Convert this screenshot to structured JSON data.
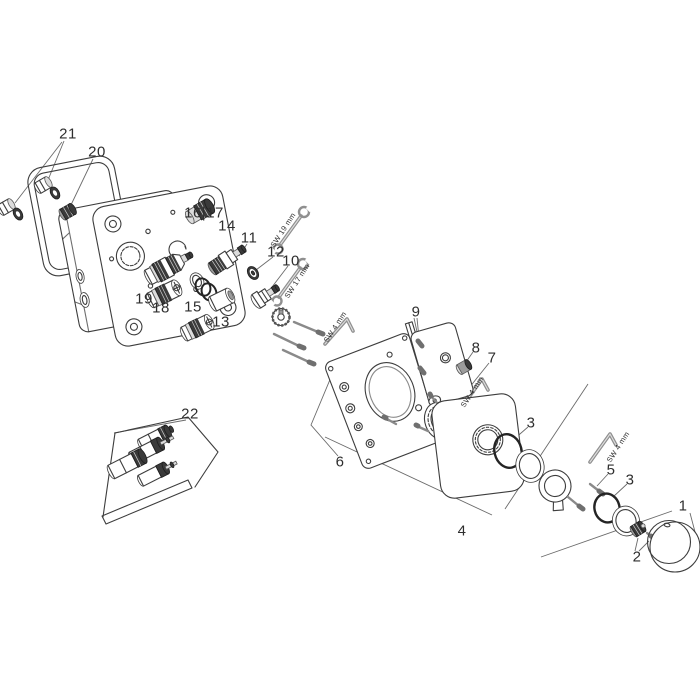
{
  "canvas": {
    "width": 700,
    "height": 700,
    "background": "#ffffff"
  },
  "style": {
    "line_color": "#3d3d3d",
    "dark_fill": "#3a3a3a",
    "leader_color": "#6b6b6b",
    "tool_color": "#8f8f8f",
    "label_color": "#2e2e2e"
  },
  "labels": {
    "parts": [
      {
        "text": "21",
        "x": 68,
        "y": 134
      },
      {
        "text": "20",
        "x": 97,
        "y": 152
      },
      {
        "text": "16|17",
        "x": 204,
        "y": 213
      },
      {
        "text": "14",
        "x": 227,
        "y": 226
      },
      {
        "text": "11",
        "x": 249,
        "y": 238
      },
      {
        "text": "12",
        "x": 276,
        "y": 252
      },
      {
        "text": "10",
        "x": 291,
        "y": 261
      },
      {
        "text": "19",
        "x": 144,
        "y": 299
      },
      {
        "text": "18",
        "x": 161,
        "y": 308
      },
      {
        "text": "15",
        "x": 193,
        "y": 307
      },
      {
        "text": "13",
        "x": 221,
        "y": 322
      },
      {
        "text": "9",
        "x": 416,
        "y": 312
      },
      {
        "text": "8",
        "x": 476,
        "y": 348
      },
      {
        "text": "7",
        "x": 492,
        "y": 358
      },
      {
        "text": "6",
        "x": 340,
        "y": 462
      },
      {
        "text": "22",
        "x": 190,
        "y": 414
      },
      {
        "text": "4",
        "x": 462,
        "y": 531
      },
      {
        "text": "3",
        "x": 531,
        "y": 423
      },
      {
        "text": "5",
        "x": 611,
        "y": 470
      },
      {
        "text": "3",
        "x": 630,
        "y": 480
      },
      {
        "text": "2",
        "x": 637,
        "y": 557
      },
      {
        "text": "1",
        "x": 683,
        "y": 506
      }
    ],
    "tools": [
      {
        "text": "SW 19 mm",
        "x": 283,
        "y": 230,
        "angle": -57
      },
      {
        "text": "SW 17 mm",
        "x": 297,
        "y": 281,
        "angle": -57
      },
      {
        "text": "SW 4 mm",
        "x": 335,
        "y": 327,
        "angle": -57
      },
      {
        "text": "SW 4 mm",
        "x": 472,
        "y": 392,
        "angle": -57
      },
      {
        "text": "SW 4 mm",
        "x": 618,
        "y": 447,
        "angle": -57
      }
    ]
  }
}
